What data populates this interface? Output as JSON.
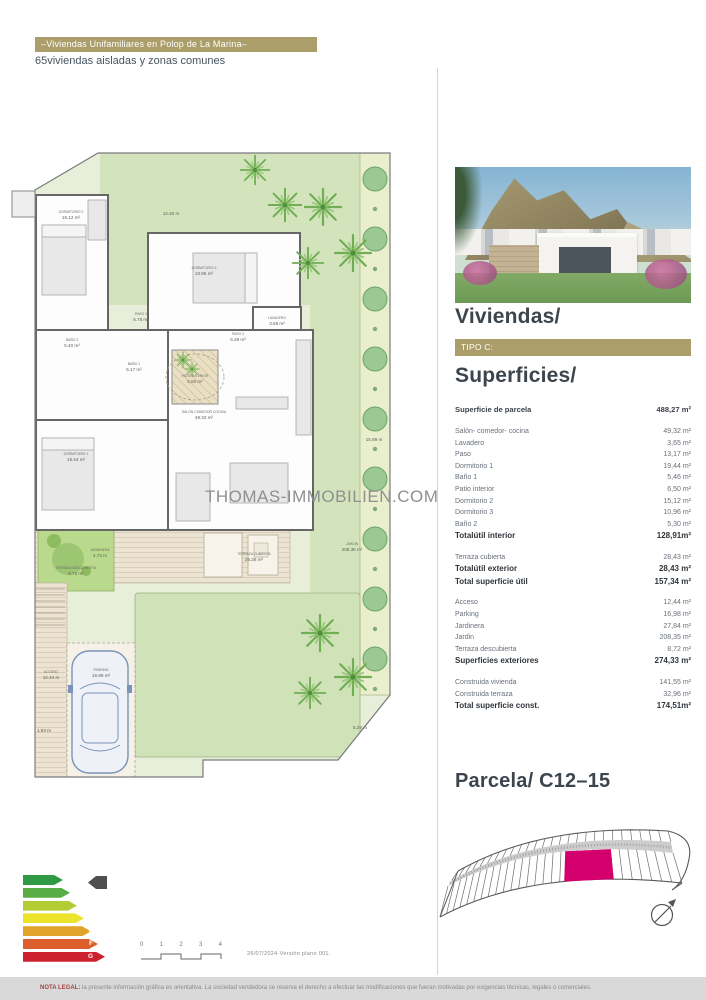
{
  "header": {
    "title_bar": "–Viviendas Unifamiliares en Polop de La Marina–",
    "subtitle": "65viviendas  aisladas y zonas comunes"
  },
  "watermark": "THOMAS-IMMOBILIEN.COM",
  "right_panel": {
    "section1_title": "Viviendas/",
    "type_badge": "TIPO C:",
    "section2_title": "Superficies/",
    "accent_color": "#ab9e6a",
    "parcel_row": {
      "label": "Superficie de parcela",
      "value": "488,27 m²"
    },
    "groups": [
      {
        "rows": [
          {
            "label": "Salón- comedor- cocina",
            "value": "49,32 m²",
            "bold": false
          },
          {
            "label": "Lavadero",
            "value": "3,65 m²",
            "bold": false
          },
          {
            "label": "Paso",
            "value": "13,17 m²",
            "bold": false
          },
          {
            "label": "Dormitorio 1",
            "value": "19,44 m²",
            "bold": false
          },
          {
            "label": "Baño 1",
            "value": "5,46 m²",
            "bold": false
          },
          {
            "label": "Patio interior",
            "value": "6,50 m²",
            "bold": false
          },
          {
            "label": "Dormitorio 2",
            "value": "15,12 m²",
            "bold": false
          },
          {
            "label": "Dormitorio 3",
            "value": "10,96 m²",
            "bold": false
          },
          {
            "label": "Baño 2",
            "value": "5,30 m²",
            "bold": false
          },
          {
            "label": "Totalútil  interior",
            "value": "128,91m²",
            "bold": true
          }
        ]
      },
      {
        "rows": [
          {
            "label": "Terraza cubierta",
            "value": "28,43 m²",
            "bold": false
          },
          {
            "label": "Totalútil  exterior",
            "value": "28,43 m²",
            "bold": true
          },
          {
            "label": "Total superficie útil",
            "value": "157,34 m²",
            "bold": true
          }
        ]
      },
      {
        "rows": [
          {
            "label": "Acceso",
            "value": "12,44 m²",
            "bold": false
          },
          {
            "label": "Parking",
            "value": "16,98 m²",
            "bold": false
          },
          {
            "label": "Jardinera",
            "value": "27,84 m²",
            "bold": false
          },
          {
            "label": "Jardin",
            "value": "208,35 m²",
            "bold": false
          },
          {
            "label": "Terraza descubierta",
            "value": "8,72 m²",
            "bold": false
          },
          {
            "label": "Superficies exteriores",
            "value": "274,33 m²",
            "bold": true
          }
        ]
      },
      {
        "rows": [
          {
            "label": "Construida vivienda",
            "value": "141,55 m²",
            "bold": false
          },
          {
            "label": "Construida terraza",
            "value": "32,96 m²",
            "bold": false
          },
          {
            "label": "Total superficie const.",
            "value": "174,51m²",
            "bold": true
          }
        ]
      }
    ],
    "parcela_title": "Parcela/ C12–15",
    "parcela_highlight_color": "#d4006e"
  },
  "plan_labels": [
    {
      "name": "DORMITORIO 2",
      "area": "15.12 m²",
      "x": 63,
      "y": 70
    },
    {
      "name": "",
      "area": "12.40 m",
      "x": 163,
      "y": 66
    },
    {
      "name": "DORMITORIO 3",
      "area": "10.95 m²",
      "x": 196,
      "y": 126
    },
    {
      "name": "PASO 1",
      "area": "6.78 m²",
      "x": 133,
      "y": 172
    },
    {
      "name": "BAÑO 2",
      "area": "5.40 m²",
      "x": 64,
      "y": 198
    },
    {
      "name": "BAÑO 1",
      "area": "5.17 m²",
      "x": 126,
      "y": 222
    },
    {
      "name": "LAVADERO",
      "area": "3.65 m²",
      "x": 269,
      "y": 176
    },
    {
      "name": "PASO 2",
      "area": "6.39 m²",
      "x": 230,
      "y": 192
    },
    {
      "name": "PATIO INTERIOR",
      "area": "6.50 m²",
      "x": 187,
      "y": 234
    },
    {
      "name": "SALÓN COMEDOR COCINA",
      "area": "49.32 m²",
      "x": 196,
      "y": 270
    },
    {
      "name": "DORMITORIO 1",
      "area": "19.44 m²",
      "x": 68,
      "y": 312
    },
    {
      "name": "",
      "area": "15.89 m",
      "x": 366,
      "y": 292
    },
    {
      "name": "JARDINERA",
      "area": "4.73 m",
      "x": 92,
      "y": 408
    },
    {
      "name": "TERRAZA DESCUBIERTA",
      "area": "8.72 m²",
      "x": 68,
      "y": 426
    },
    {
      "name": "TERRAZA CUBIERTA",
      "area": "26.28 m²",
      "x": 246,
      "y": 412
    },
    {
      "name": "JARDIN",
      "area": "208.35 m²",
      "x": 344,
      "y": 402
    },
    {
      "name": "ACCESO",
      "area": "12.44 m",
      "x": 43,
      "y": 530
    },
    {
      "name": "PARKING",
      "area": "16.98 m²",
      "x": 93,
      "y": 528
    },
    {
      "name": "",
      "area": "1.93 m",
      "x": 36,
      "y": 583
    },
    {
      "name": "",
      "area": "5.29 m",
      "x": 352,
      "y": 580
    }
  ],
  "energy": {
    "ratings": [
      {
        "label": "A",
        "color": "#2e9b44"
      },
      {
        "label": "B",
        "color": "#58ad44"
      },
      {
        "label": "C",
        "color": "#b2cc34"
      },
      {
        "label": "D",
        "color": "#ece32b"
      },
      {
        "label": "E",
        "color": "#e2a32a"
      },
      {
        "label": "F",
        "color": "#dc5f2b"
      },
      {
        "label": "G",
        "color": "#cd2130"
      }
    ]
  },
  "scale": {
    "labels": [
      "0",
      "1",
      "2",
      "3",
      "4"
    ]
  },
  "footer": {
    "date_version": "26/07/2024·Versión  plano  001.",
    "legal_prefix": "NOTA LEGAL:",
    "legal_text": " la presente información gráfica es orientativa. La sociedad vendedora se reserva el derecho a efectuar las modificaciones que fueran motivadas por exigencias técnicas, legales o comerciales."
  }
}
